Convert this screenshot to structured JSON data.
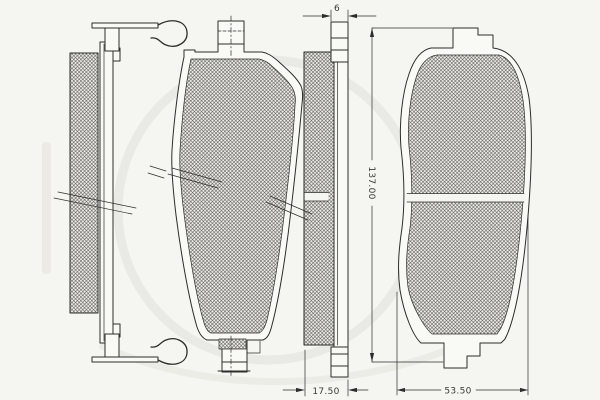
{
  "dimensions": {
    "plate_thickness": "6",
    "pad_length": "137.00",
    "total_thickness": "17.50",
    "pad_width": "53.50"
  },
  "colors": {
    "background": "#f5f5f1",
    "line": "#2d2d2b",
    "dim_text": "#3a3a38",
    "watermark": "#dededa"
  }
}
